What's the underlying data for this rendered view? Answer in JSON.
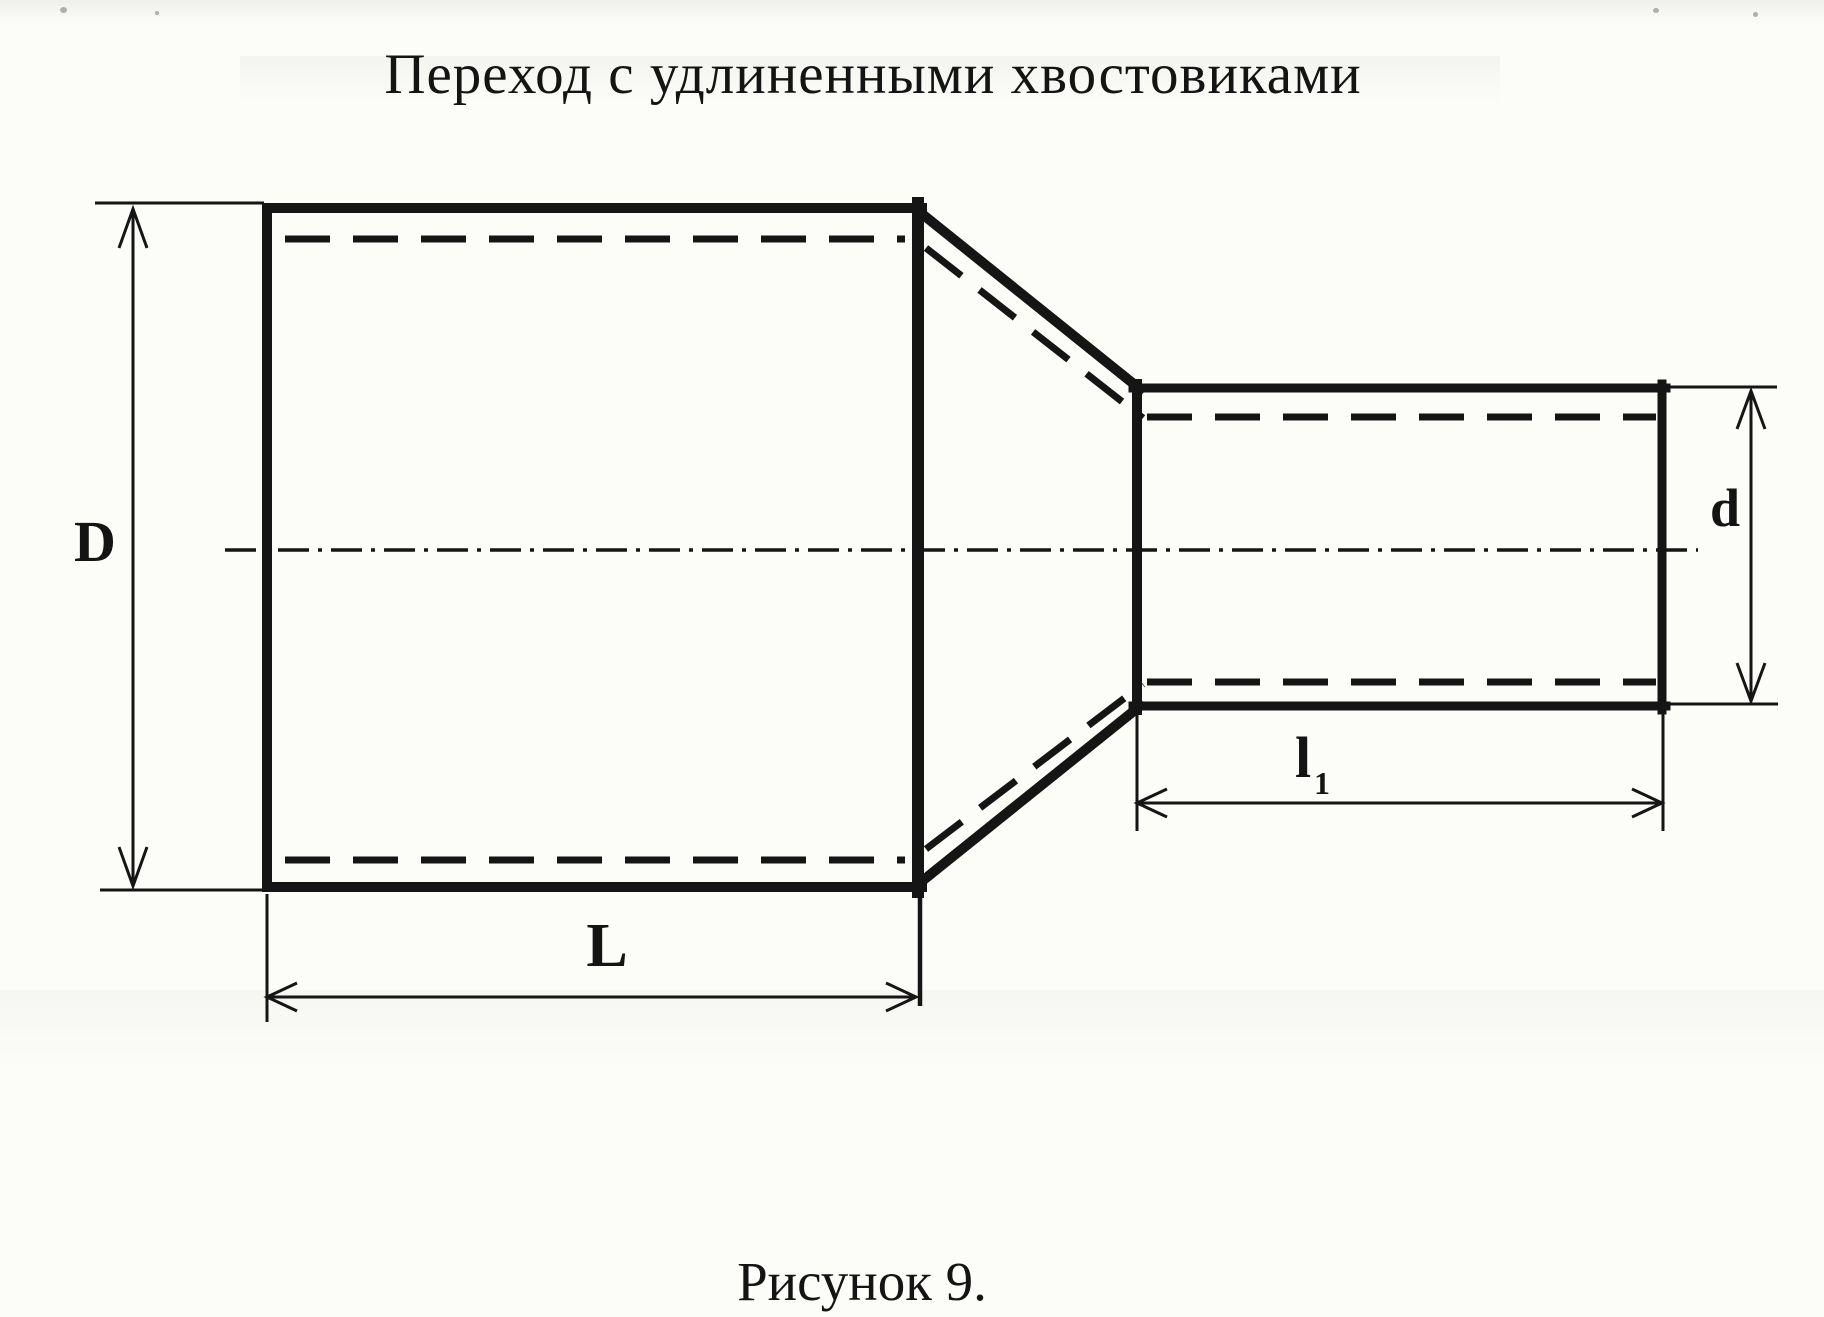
{
  "title": "Переход с удлиненными хвостовиками",
  "caption": "Рисунок 9.",
  "labels": {
    "large_diameter": "D",
    "small_diameter": "d",
    "large_length": "L",
    "small_length_main": "l",
    "small_length_sub": "1"
  },
  "colors": {
    "ink": "#151515",
    "paper": "#fcfcf9"
  }
}
